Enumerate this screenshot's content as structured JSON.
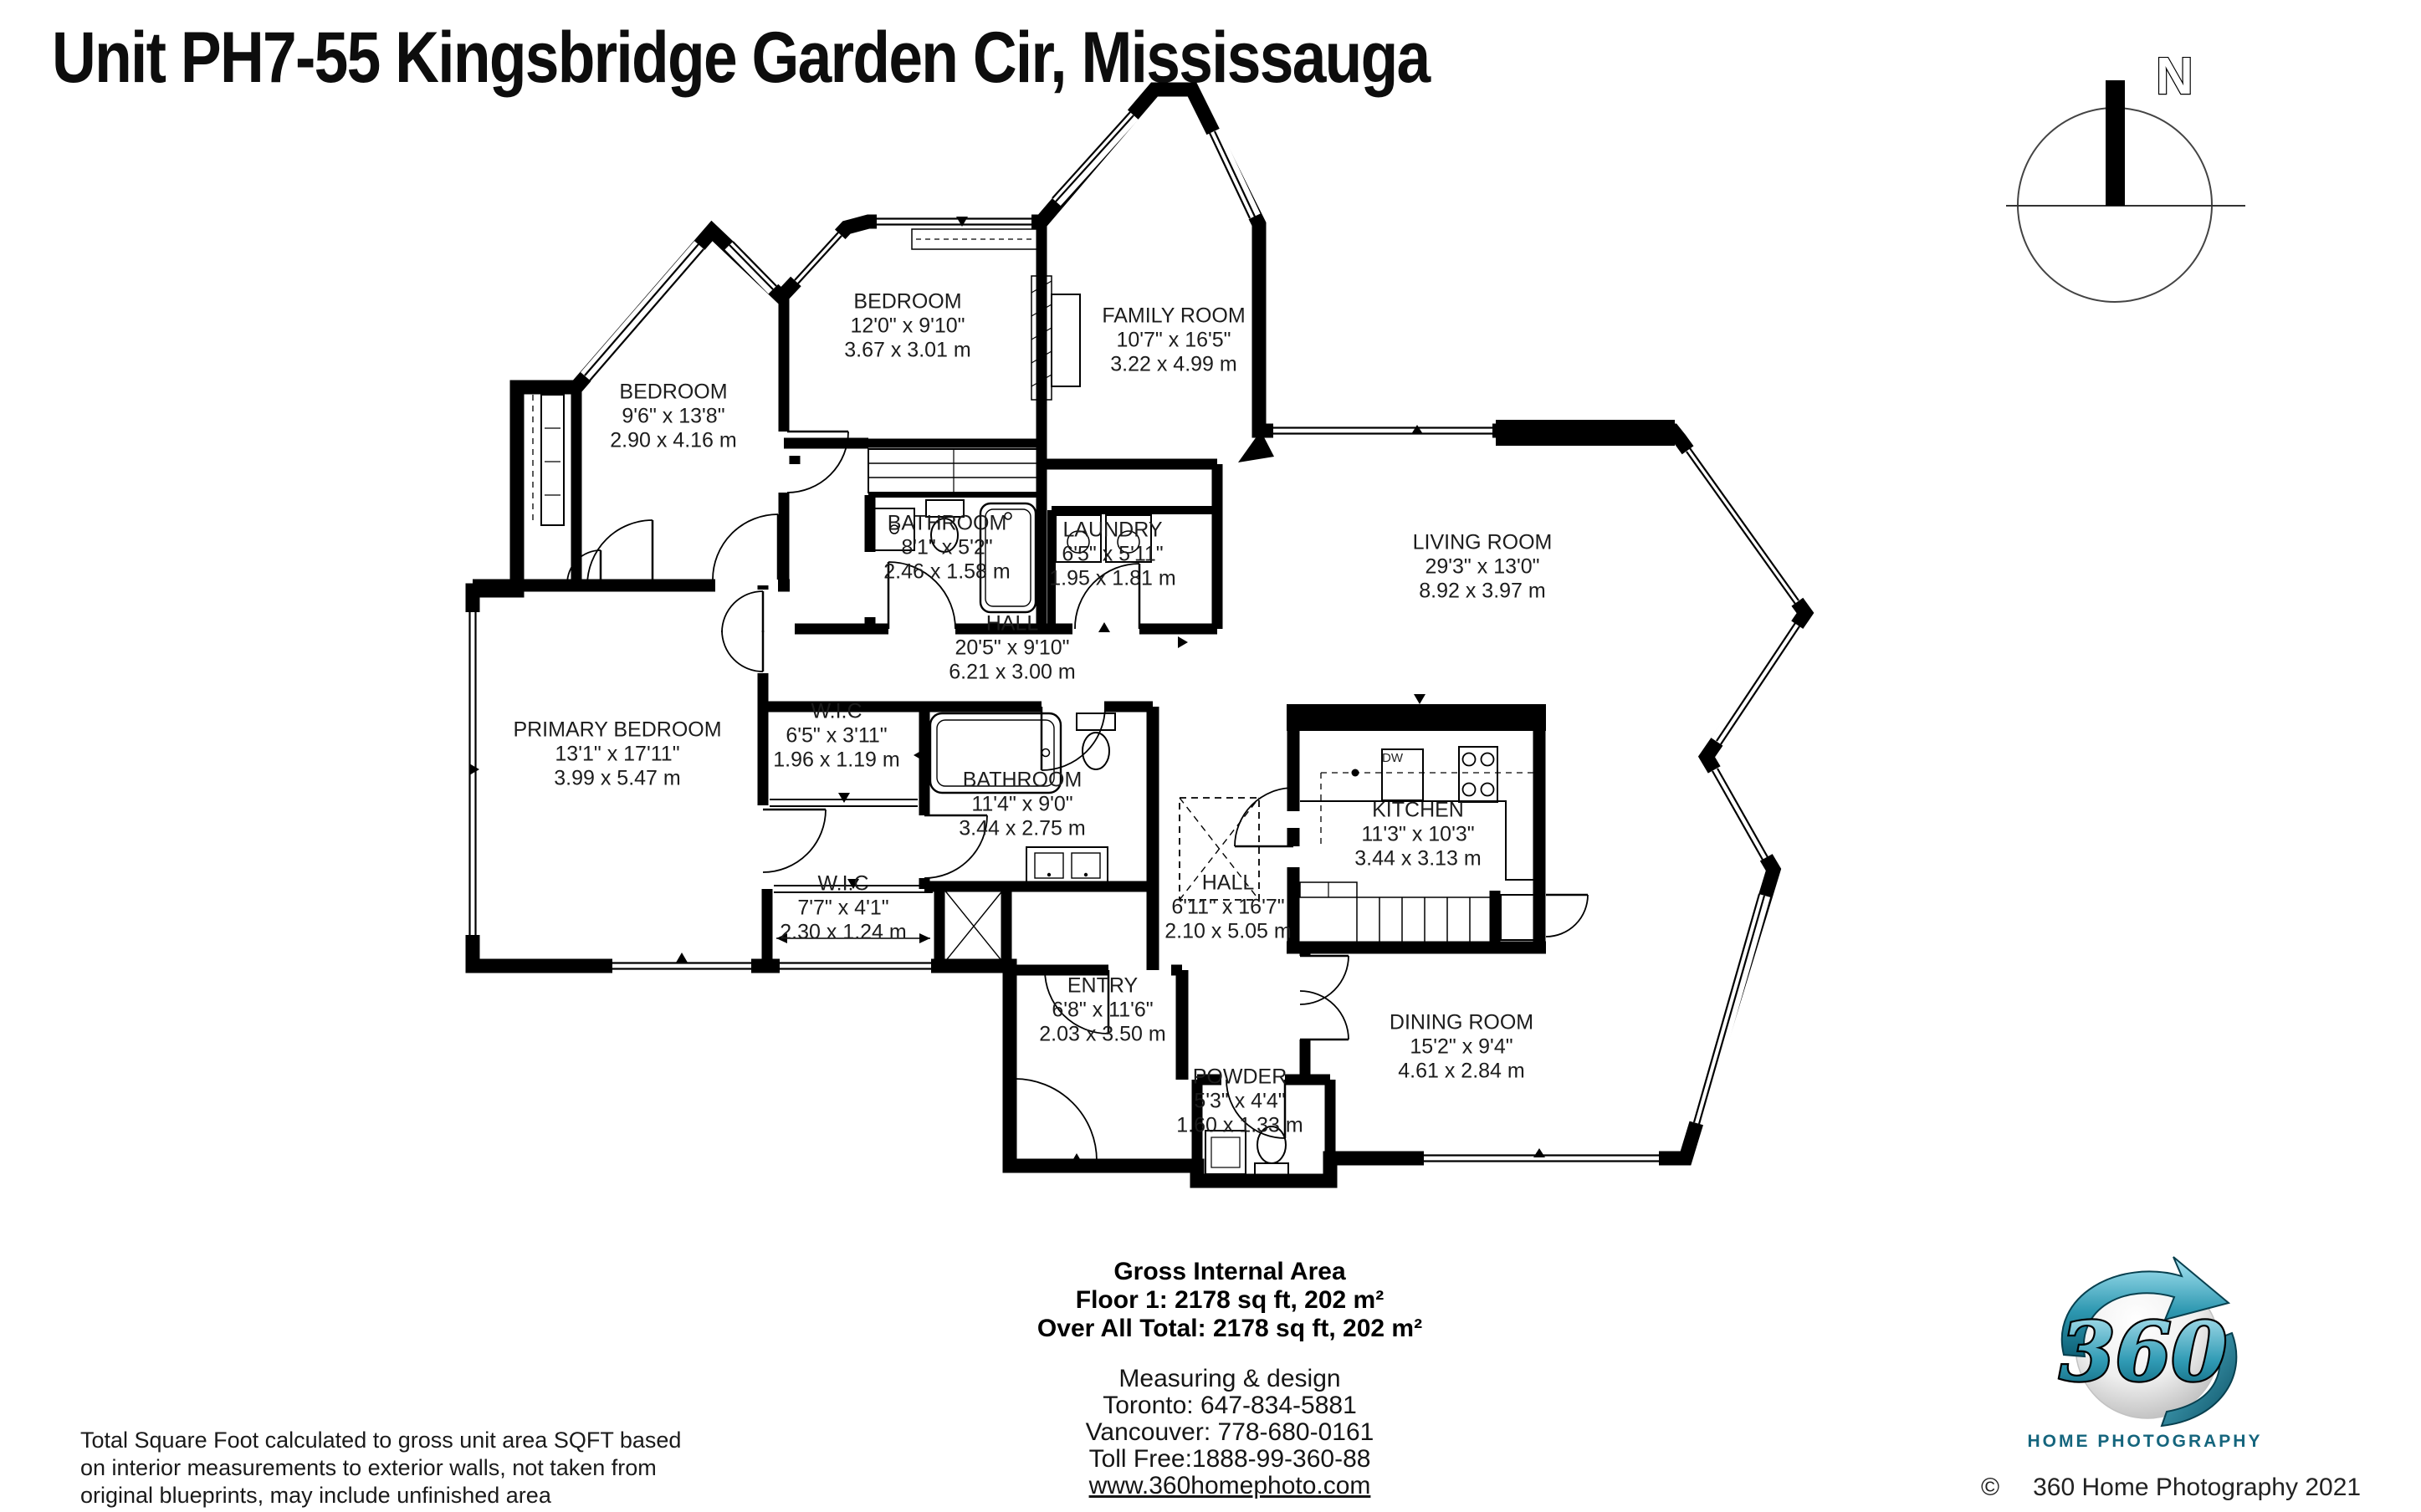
{
  "title": "Unit PH7-55 Kingsbridge Garden Cir, Mississauga",
  "compass": {
    "north_label": "N"
  },
  "plan": {
    "dw_label": "DW"
  },
  "rooms": [
    {
      "name": "BEDROOM",
      "imperial": "12'0\" x 9'10\"",
      "metric": "3.67 x 3.01 m"
    },
    {
      "name": "FAMILY ROOM",
      "imperial": "10'7\" x 16'5\"",
      "metric": "3.22 x 4.99 m"
    },
    {
      "name": "BEDROOM",
      "imperial": "9'6\" x 13'8\"",
      "metric": "2.90 x 4.16 m"
    },
    {
      "name": "BATHROOM",
      "imperial": "8'1\" x 5'2\"",
      "metric": "2.46 x 1.58 m"
    },
    {
      "name": "LAUNDRY",
      "imperial": "6'5\" x 5'11\"",
      "metric": "1.95 x 1.81 m"
    },
    {
      "name": "LIVING ROOM",
      "imperial": "29'3\" x 13'0\"",
      "metric": "8.92 x 3.97 m"
    },
    {
      "name": "HALL",
      "imperial": "20'5\" x 9'10\"",
      "metric": "6.21 x 3.00 m"
    },
    {
      "name": "W.I.C",
      "imperial": "6'5\" x 3'11\"",
      "metric": "1.96 x 1.19 m"
    },
    {
      "name": "PRIMARY BEDROOM",
      "imperial": "13'1\" x 17'11\"",
      "metric": "3.99 x 5.47 m"
    },
    {
      "name": "BATHROOM",
      "imperial": "11'4\" x 9'0\"",
      "metric": "3.44 x 2.75 m"
    },
    {
      "name": "KITCHEN",
      "imperial": "11'3\" x 10'3\"",
      "metric": "3.44 x 3.13 m"
    },
    {
      "name": "W.I.C",
      "imperial": "7'7\" x 4'1\"",
      "metric": "2.30 x 1.24 m"
    },
    {
      "name": "HALL",
      "imperial": "6'11\" x 16'7\"",
      "metric": "2.10 x 5.05 m"
    },
    {
      "name": "ENTRY",
      "imperial": "6'8\" x 11'6\"",
      "metric": "2.03 x 3.50 m"
    },
    {
      "name": "DINING ROOM",
      "imperial": "15'2\" x 9'4\"",
      "metric": "4.61 x 2.84 m"
    },
    {
      "name": "POWDER",
      "imperial": "5'3\" x 4'4\"",
      "metric": "1.60 x 1.33 m"
    }
  ],
  "area_summary": {
    "heading": "Gross Internal Area",
    "floor": "Floor 1: 2178 sq ft, 202 m²",
    "total": "Over All Total: 2178 sq ft, 202 m²"
  },
  "contact": {
    "tagline": "Measuring & design",
    "toronto": "Toronto: 647-834-5881",
    "vancouver": "Vancouver: 778-680-0161",
    "toll_free": "Toll Free:1888-99-360-88",
    "website": "www.360homephoto.com"
  },
  "disclaimer": "Total Square Foot calculated to gross unit area SQFT based on interior measurements to exterior walls, not taken from original blueprints, may include unfinished area",
  "logo": {
    "number": "360",
    "wordmark": "HOME PHOTOGRAPHY",
    "copyright_symbol": "©",
    "copyright_text": "360 Home Photography 2021",
    "teal": "#1b7e95"
  },
  "colors": {
    "walls": "#000000",
    "background": "#ffffff"
  }
}
